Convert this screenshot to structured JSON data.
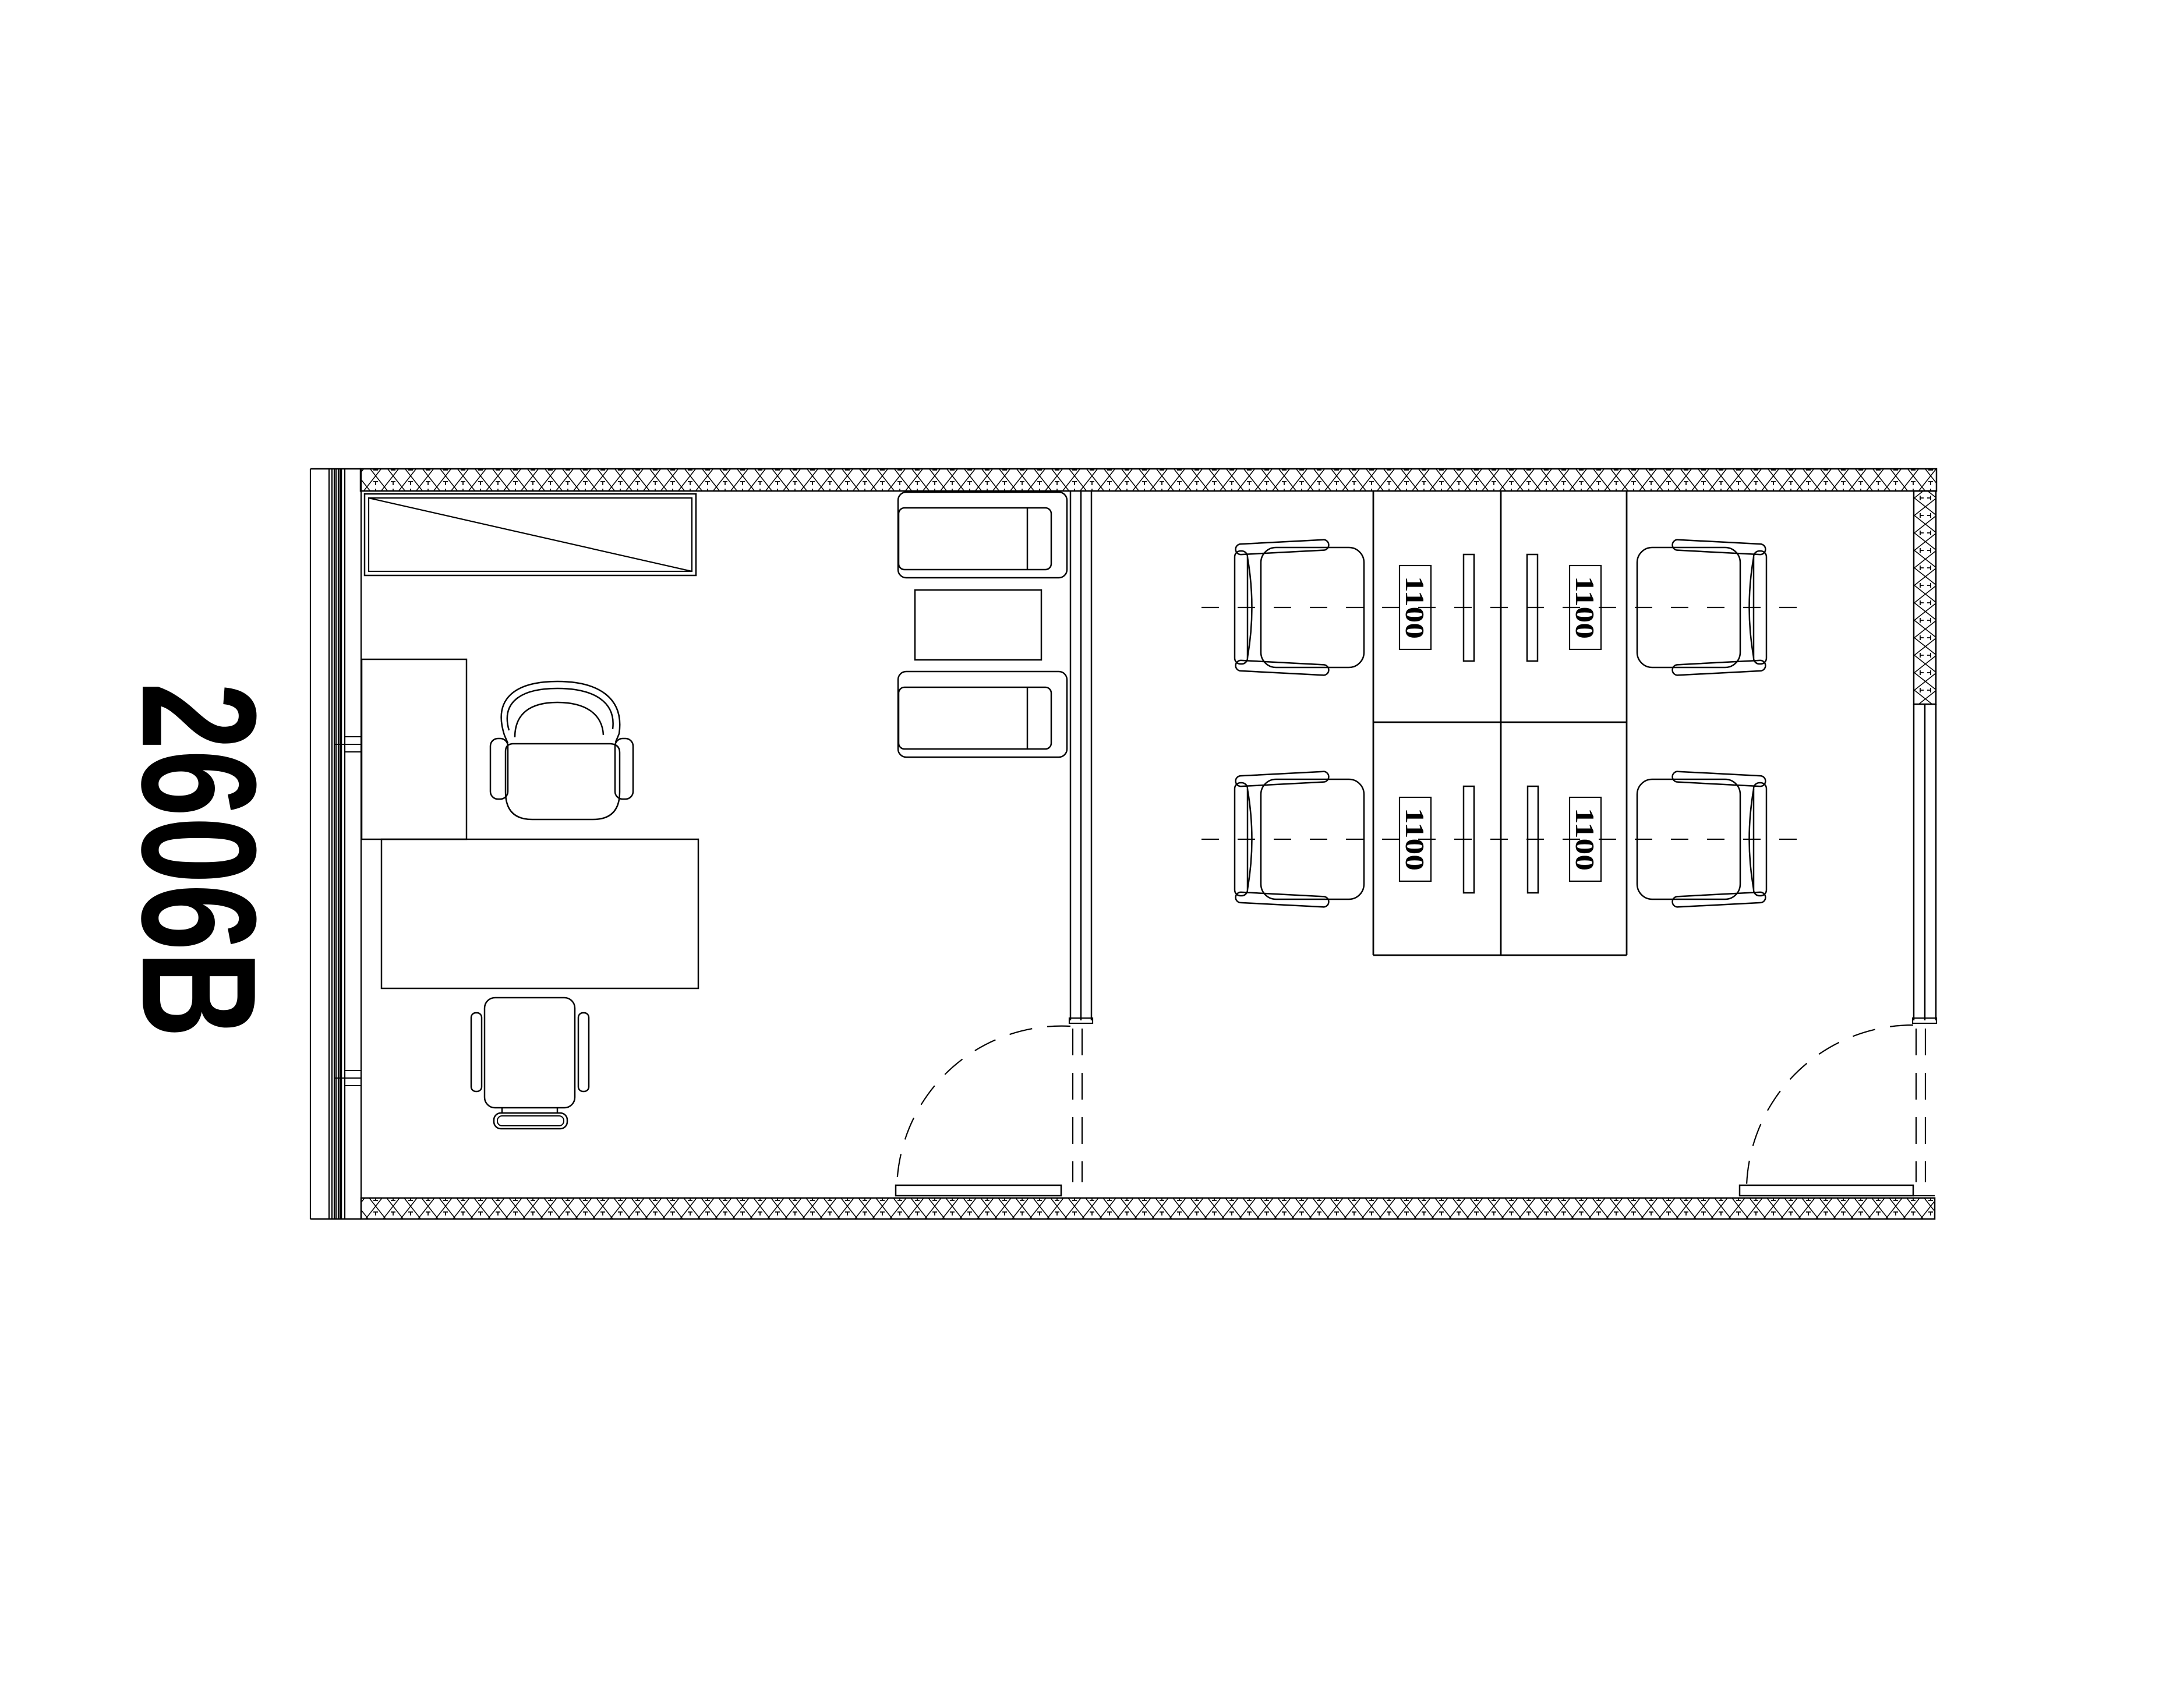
{
  "page": {
    "background_color": "#ffffff",
    "line_color": "#000000"
  },
  "plan": {
    "room_label": "2606B",
    "workstation_tags": [
      {
        "label": "1100",
        "row": "top",
        "column": "left"
      },
      {
        "label": "1100",
        "row": "top",
        "column": "right"
      },
      {
        "label": "1100",
        "row": "bottom",
        "column": "left"
      },
      {
        "label": "1100",
        "row": "bottom",
        "column": "right"
      }
    ]
  }
}
